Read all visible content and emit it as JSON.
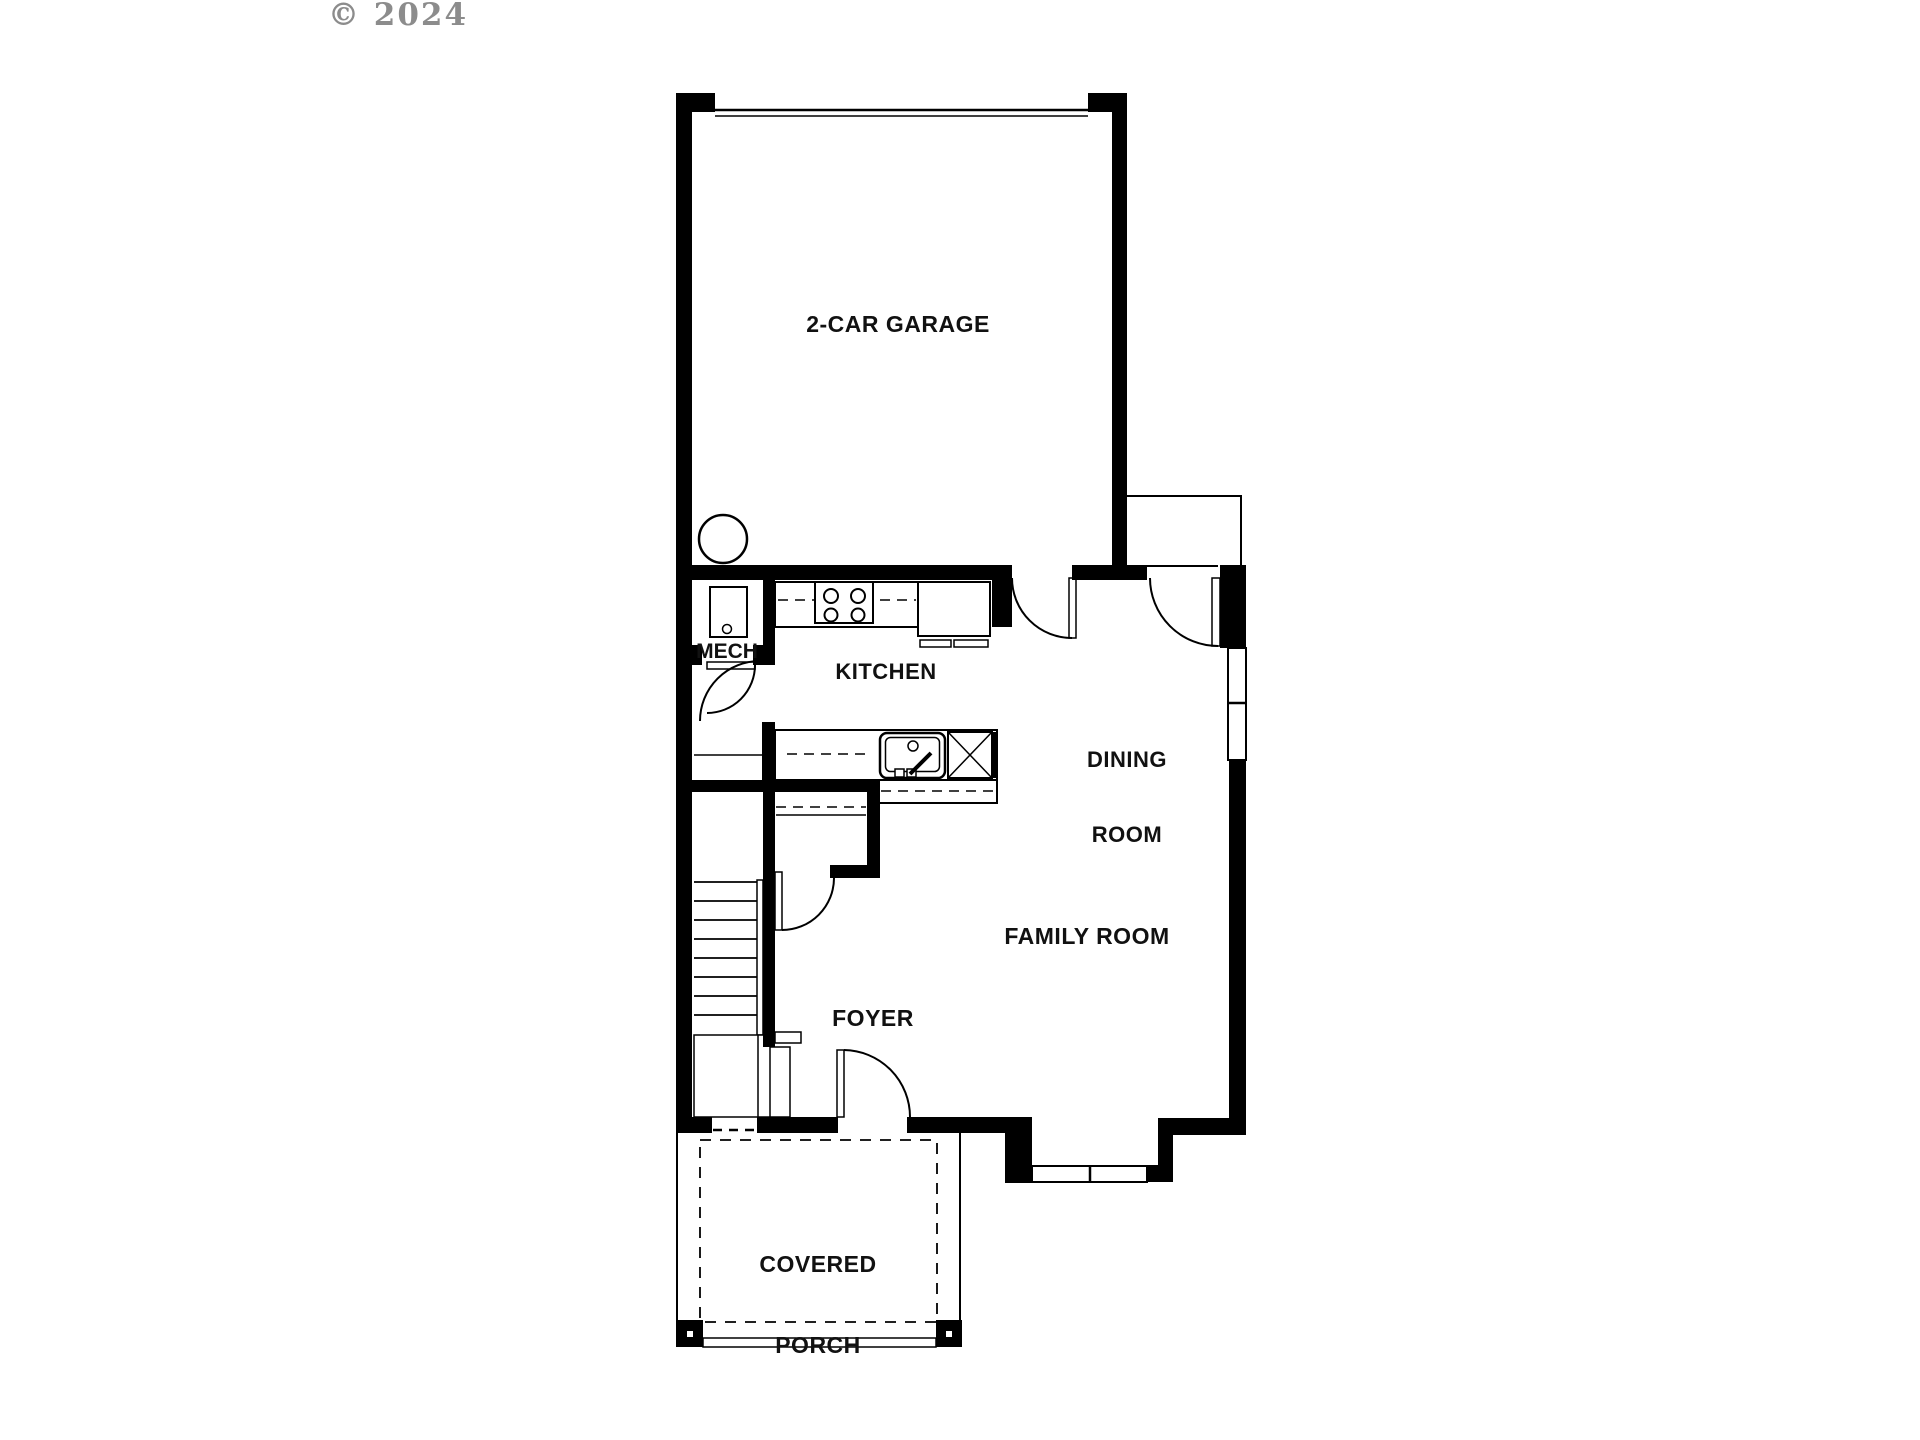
{
  "copyright": "© 2024",
  "colors": {
    "wall": "#000000",
    "label": "#111111",
    "copyright": "#8c8c8c",
    "background": "#ffffff"
  },
  "rooms": {
    "garage": {
      "label": "2-CAR GARAGE"
    },
    "kitchen": {
      "label": "KITCHEN"
    },
    "dining": {
      "line1": "DINING",
      "line2": "ROOM"
    },
    "family_room": {
      "label": "FAMILY ROOM"
    },
    "foyer": {
      "label": "FOYER"
    },
    "mech": {
      "label": "MECH"
    },
    "covered_porch": {
      "line1": "COVERED",
      "line2": "PORCH"
    }
  }
}
